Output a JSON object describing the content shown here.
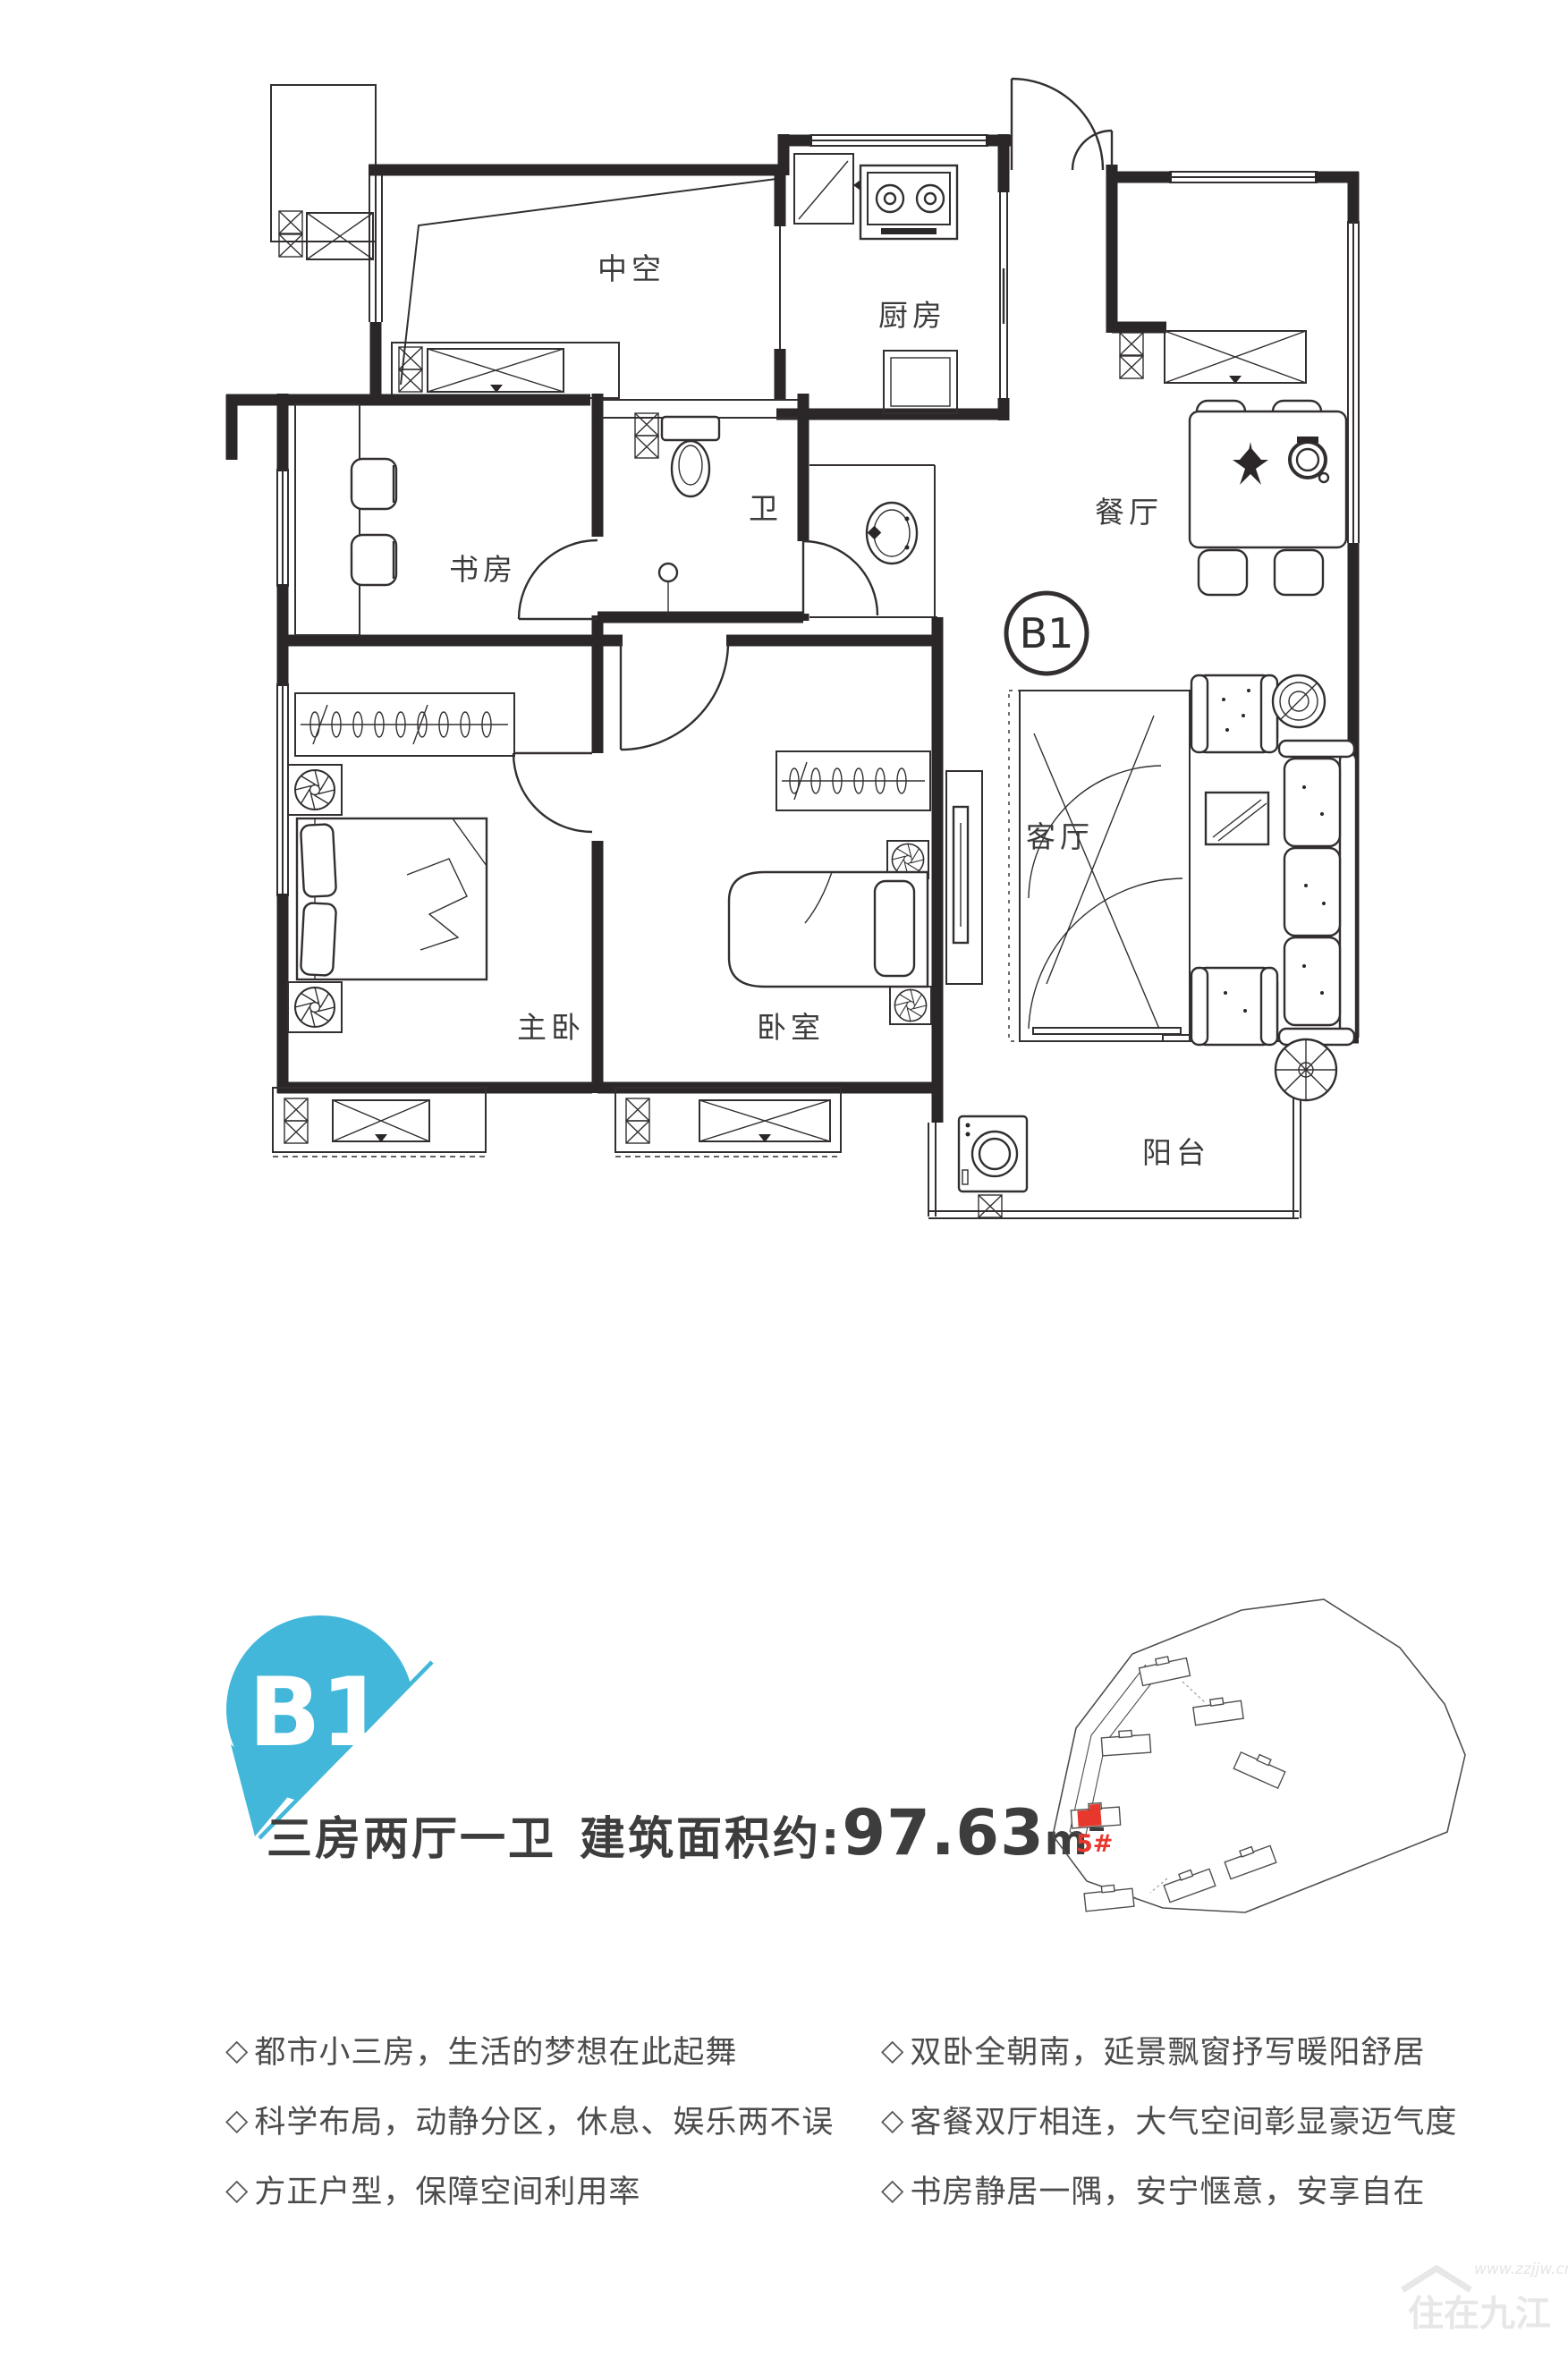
{
  "plan": {
    "unit_circle_label": "B1",
    "rooms": {
      "void": "中空",
      "kitchen": "厨房",
      "dining": "餐厅",
      "study": "书房",
      "bath": "卫",
      "living": "客厅",
      "master": "主卧",
      "bedroom": "卧室",
      "balcony": "阳台"
    }
  },
  "badge": {
    "label": "B1"
  },
  "summary": {
    "layout": "三房两厅一卫",
    "area_label": "建筑面积约:",
    "area_value": "97.63",
    "area_unit": "m",
    "area_sup": "2"
  },
  "features": {
    "bullet": "◇",
    "left": [
      "都市小三房，生活的梦想在此起舞",
      "科学布局，动静分区，休息、娱乐两不误",
      "方正户型，保障空间利用率"
    ],
    "right": [
      "双卧全朝南，延景飘窗抒写暖阳舒居",
      "客餐双厅相连，大气空间彰显豪迈气度",
      "书房静居一隅，安宁惬意，安享自在"
    ]
  },
  "site_map": {
    "highlight_label": "5#"
  },
  "watermark": {
    "site_name": "住在九江",
    "url": "www.zzjjw.cn"
  },
  "colors": {
    "accent_teal": "#43b7d9",
    "highlight_red": "#e8382d"
  }
}
